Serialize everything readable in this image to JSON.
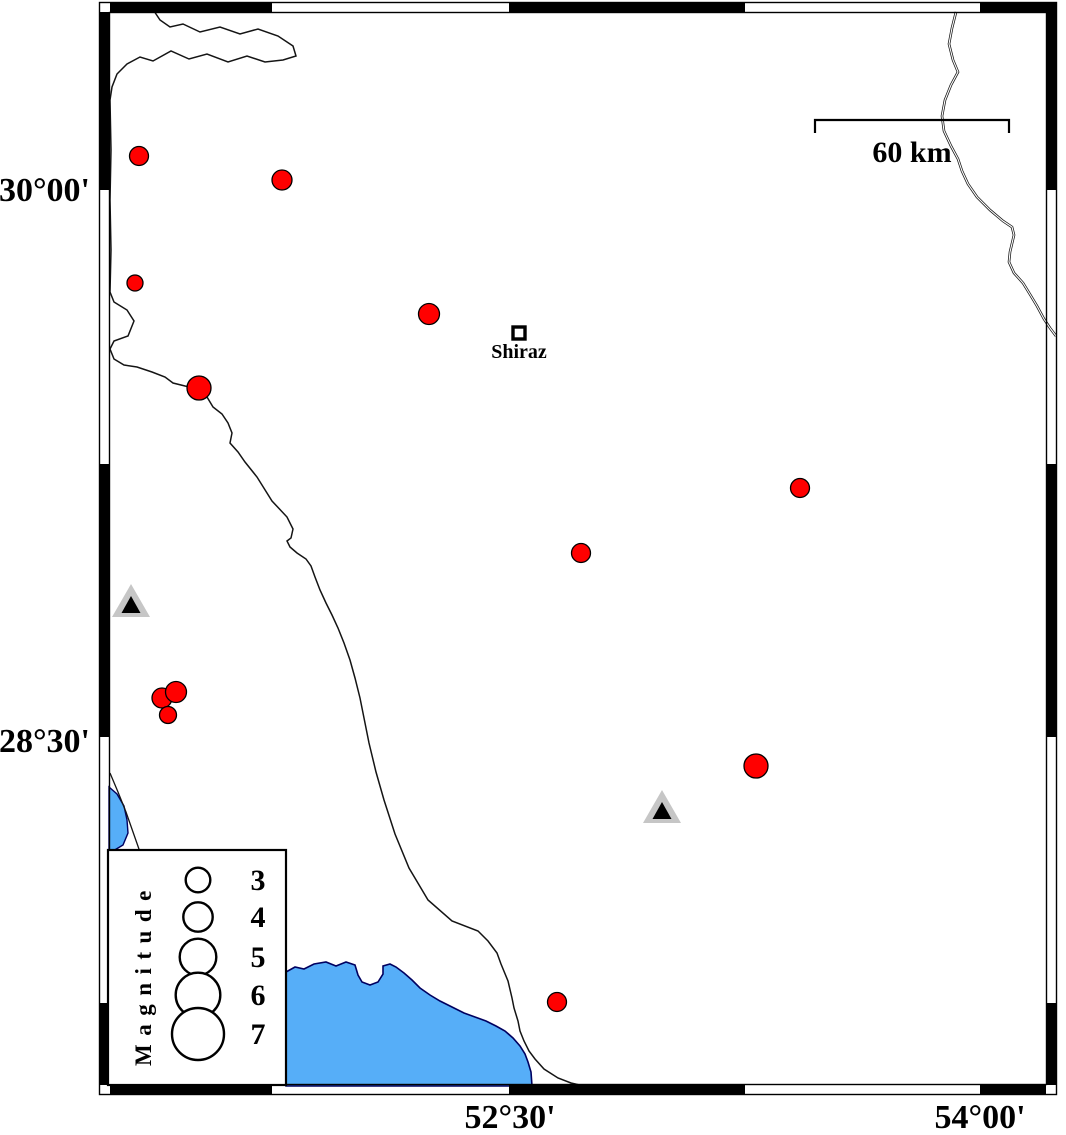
{
  "figure": {
    "type": "seismicity-map",
    "width": 1066,
    "height": 1135
  },
  "map_data": {
    "colors": {
      "epicenter": "#ff0000",
      "epicenter_outline": "#000000",
      "water": "#56aef8",
      "shoreline": "#000060",
      "station_outer": "#c6c6c6",
      "station_inner": "#000000",
      "frame": "#000000",
      "line": "#141414",
      "background": "#ffffff"
    },
    "axes": {
      "left_ticks": [
        {
          "label": "30°00'",
          "y": 188
        },
        {
          "label": "28°30'",
          "y": 739
        }
      ],
      "bottom_ticks": [
        {
          "label": "52°30'",
          "x": 510
        },
        {
          "label": "54°00'",
          "x": 980
        }
      ]
    },
    "frame": {
      "outer": {
        "x": 99,
        "y": 2,
        "w": 958,
        "h": 1093
      },
      "inner": {
        "x": 109,
        "y": 12,
        "w": 938,
        "h": 1073
      },
      "thickness": 10,
      "black_top": [
        [
          110,
          272
        ],
        [
          509,
          745
        ],
        [
          980,
          1056
        ]
      ],
      "black_bottom": [
        [
          110,
          272
        ],
        [
          509,
          745
        ],
        [
          980,
          1046
        ]
      ],
      "black_left": [
        [
          12,
          190
        ],
        [
          464,
          737
        ],
        [
          1003,
          1085
        ]
      ],
      "black_right": [
        [
          3,
          190
        ],
        [
          464,
          737
        ],
        [
          1003,
          1085
        ]
      ]
    },
    "scale_bar": {
      "label": "60 km",
      "x1": 815,
      "x2": 1009,
      "y": 120,
      "tick_drop": 13,
      "label_x": 912,
      "label_y": 162
    },
    "city": {
      "name": "Shiraz",
      "x": 519,
      "y": 333,
      "label_y": 358
    },
    "legend": {
      "title": "Magnitude",
      "box": {
        "x": 108,
        "y": 850,
        "w": 178,
        "h": 235
      },
      "circle_cx": 198,
      "number_x": 258,
      "entries": [
        {
          "label": "3",
          "cy": 880,
          "r": 12.3
        },
        {
          "label": "4",
          "cy": 917,
          "r": 14.7
        },
        {
          "label": "5",
          "cy": 957,
          "r": 18.3
        },
        {
          "label": "6",
          "cy": 995,
          "r": 22.3
        },
        {
          "label": "7",
          "cy": 1034,
          "r": 26
        }
      ]
    },
    "earthquakes": [
      {
        "x": 139,
        "y": 156,
        "r": 9.5
      },
      {
        "x": 282,
        "y": 180,
        "r": 10
      },
      {
        "x": 135,
        "y": 283,
        "r": 8
      },
      {
        "x": 429,
        "y": 314,
        "r": 10.5
      },
      {
        "x": 199,
        "y": 388,
        "r": 12
      },
      {
        "x": 162,
        "y": 698,
        "r": 10
      },
      {
        "x": 176,
        "y": 692,
        "r": 10.5
      },
      {
        "x": 168,
        "y": 715,
        "r": 8.5
      },
      {
        "x": 581,
        "y": 553,
        "r": 9.5
      },
      {
        "x": 800,
        "y": 488,
        "r": 9.5
      },
      {
        "x": 756,
        "y": 766,
        "r": 12
      },
      {
        "x": 557,
        "y": 1002,
        "r": 9.5
      }
    ],
    "stations": [
      {
        "x": 131,
        "y": 601
      },
      {
        "x": 662,
        "y": 807
      }
    ],
    "coastlines": {
      "border_line": [
        [
          152,
          8
        ],
        [
          160,
          20
        ],
        [
          170,
          27
        ],
        [
          183,
          24
        ],
        [
          200,
          32
        ],
        [
          220,
          27
        ],
        [
          240,
          34
        ],
        [
          258,
          29
        ],
        [
          278,
          36
        ],
        [
          293,
          46
        ],
        [
          296,
          56
        ],
        [
          283,
          60
        ],
        [
          265,
          62
        ],
        [
          247,
          56
        ],
        [
          228,
          62
        ],
        [
          207,
          54
        ],
        [
          189,
          59
        ],
        [
          171,
          51
        ],
        [
          153,
          61
        ],
        [
          140,
          57
        ],
        [
          127,
          64
        ],
        [
          117,
          74
        ],
        [
          112,
          87
        ],
        [
          110,
          100
        ],
        [
          111,
          150
        ],
        [
          110,
          200
        ],
        [
          111,
          250
        ],
        [
          110,
          292
        ],
        [
          114,
          302
        ],
        [
          127,
          310
        ],
        [
          134,
          321
        ],
        [
          128,
          336
        ],
        [
          114,
          341
        ],
        [
          110,
          349
        ],
        [
          114,
          359
        ],
        [
          124,
          365
        ],
        [
          137,
          367
        ],
        [
          152,
          372
        ],
        [
          165,
          377
        ],
        [
          173,
          383
        ],
        [
          185,
          386
        ],
        [
          199,
          389
        ],
        [
          207,
          397
        ],
        [
          213,
          407
        ],
        [
          222,
          414
        ],
        [
          228,
          423
        ],
        [
          232,
          433
        ],
        [
          230,
          443
        ],
        [
          238,
          452
        ],
        [
          245,
          462
        ],
        [
          257,
          477
        ],
        [
          272,
          501
        ],
        [
          287,
          517
        ],
        [
          293,
          529
        ],
        [
          291,
          538
        ],
        [
          287,
          541
        ],
        [
          290,
          547
        ],
        [
          297,
          553
        ],
        [
          306,
          559
        ],
        [
          311,
          566
        ],
        [
          315,
          577
        ],
        [
          320,
          590
        ],
        [
          326,
          603
        ],
        [
          332,
          615
        ],
        [
          338,
          628
        ],
        [
          344,
          643
        ],
        [
          350,
          660
        ],
        [
          355,
          678
        ],
        [
          360,
          698
        ],
        [
          364,
          718
        ],
        [
          369,
          743
        ],
        [
          376,
          772
        ],
        [
          384,
          800
        ],
        [
          395,
          834
        ],
        [
          409,
          868
        ],
        [
          428,
          900
        ],
        [
          452,
          921
        ],
        [
          478,
          931
        ],
        [
          488,
          941
        ],
        [
          497,
          953
        ],
        [
          501,
          964
        ],
        [
          508,
          981
        ],
        [
          512,
          998
        ],
        [
          514,
          1008
        ],
        [
          518,
          1021
        ],
        [
          520,
          1031
        ],
        [
          524,
          1041
        ],
        [
          529,
          1051
        ],
        [
          535,
          1059
        ],
        [
          544,
          1069
        ],
        [
          558,
          1078
        ],
        [
          571,
          1083
        ],
        [
          584,
          1086
        ]
      ],
      "river": [
        [
          956,
          12
        ],
        [
          952,
          28
        ],
        [
          949,
          44
        ],
        [
          953,
          60
        ],
        [
          958,
          72
        ],
        [
          951,
          85
        ],
        [
          945,
          100
        ],
        [
          942,
          116
        ],
        [
          944,
          131
        ],
        [
          951,
          146
        ],
        [
          958,
          159
        ],
        [
          962,
          171
        ],
        [
          968,
          184
        ],
        [
          977,
          197
        ],
        [
          990,
          210
        ],
        [
          1003,
          221
        ],
        [
          1012,
          227
        ],
        [
          1014,
          235
        ],
        [
          1010,
          252
        ],
        [
          1009,
          262
        ],
        [
          1014,
          273
        ],
        [
          1023,
          283
        ],
        [
          1031,
          296
        ],
        [
          1037,
          306
        ],
        [
          1044,
          319
        ],
        [
          1050,
          328
        ],
        [
          1056,
          336
        ]
      ],
      "coast_segment": [
        [
          110,
          773
        ],
        [
          118,
          792
        ],
        [
          126,
          812
        ],
        [
          133,
          832
        ],
        [
          140,
          852
        ]
      ]
    },
    "water": {
      "lake": [
        [
          286,
          1086
        ],
        [
          286,
          972
        ],
        [
          295,
          967
        ],
        [
          304,
          969
        ],
        [
          314,
          964
        ],
        [
          326,
          962
        ],
        [
          336,
          966
        ],
        [
          346,
          962
        ],
        [
          355,
          965
        ],
        [
          358,
          975
        ],
        [
          362,
          982
        ],
        [
          370,
          985
        ],
        [
          378,
          982
        ],
        [
          383,
          974
        ],
        [
          383,
          966
        ],
        [
          390,
          964
        ],
        [
          396,
          967
        ],
        [
          404,
          973
        ],
        [
          412,
          980
        ],
        [
          420,
          988
        ],
        [
          430,
          995
        ],
        [
          440,
          1001
        ],
        [
          452,
          1007
        ],
        [
          464,
          1013
        ],
        [
          475,
          1017
        ],
        [
          486,
          1021
        ],
        [
          496,
          1026
        ],
        [
          505,
          1031
        ],
        [
          513,
          1038
        ],
        [
          520,
          1046
        ],
        [
          525,
          1054
        ],
        [
          528,
          1062
        ],
        [
          531,
          1072
        ],
        [
          532,
          1086
        ]
      ],
      "small_patch": [
        [
          109,
          787
        ],
        [
          117,
          794
        ],
        [
          124,
          806
        ],
        [
          127,
          820
        ],
        [
          128,
          833
        ],
        [
          123,
          845
        ],
        [
          113,
          851
        ],
        [
          109,
          853
        ]
      ]
    }
  }
}
